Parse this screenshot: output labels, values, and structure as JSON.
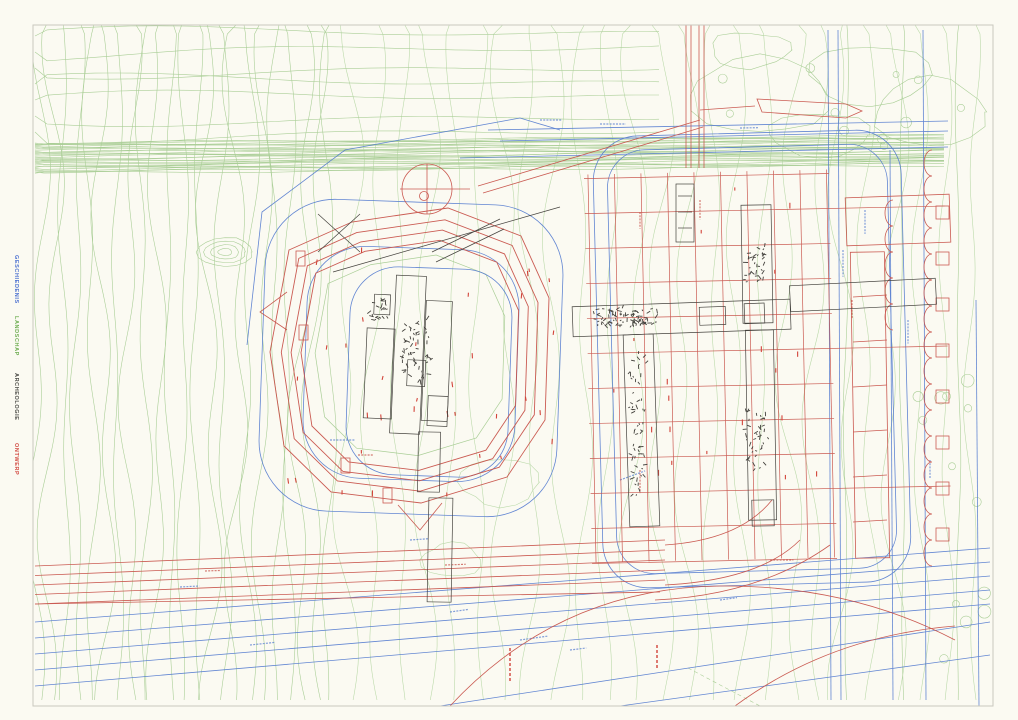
{
  "page": {
    "background": "#fbfaf2",
    "border_color": "#c9c8bf"
  },
  "legend": {
    "items": [
      {
        "id": "geschiedenis",
        "label": "GESCHIEDENIS",
        "color": "#4a6fd0",
        "top": 255
      },
      {
        "id": "landschap",
        "label": "LANDSCHAP",
        "color": "#6fae53",
        "top": 316
      },
      {
        "id": "archeologie",
        "label": "ARCHEOLOGIE",
        "color": "#4a4a46",
        "top": 373
      },
      {
        "id": "ontwerp",
        "label": "ONTWERP",
        "color": "#d24a42",
        "top": 443
      }
    ]
  },
  "map": {
    "frame": {
      "x": 33,
      "y": 25,
      "w": 960,
      "h": 681
    },
    "colors": {
      "landscape": "#a6cc92",
      "landscape_soft": "#b8d8a6",
      "history": "#5179cf",
      "archaeology": "#45433e",
      "design": "#c8534a",
      "design_bright": "#d03a30"
    },
    "seed": 13
  }
}
